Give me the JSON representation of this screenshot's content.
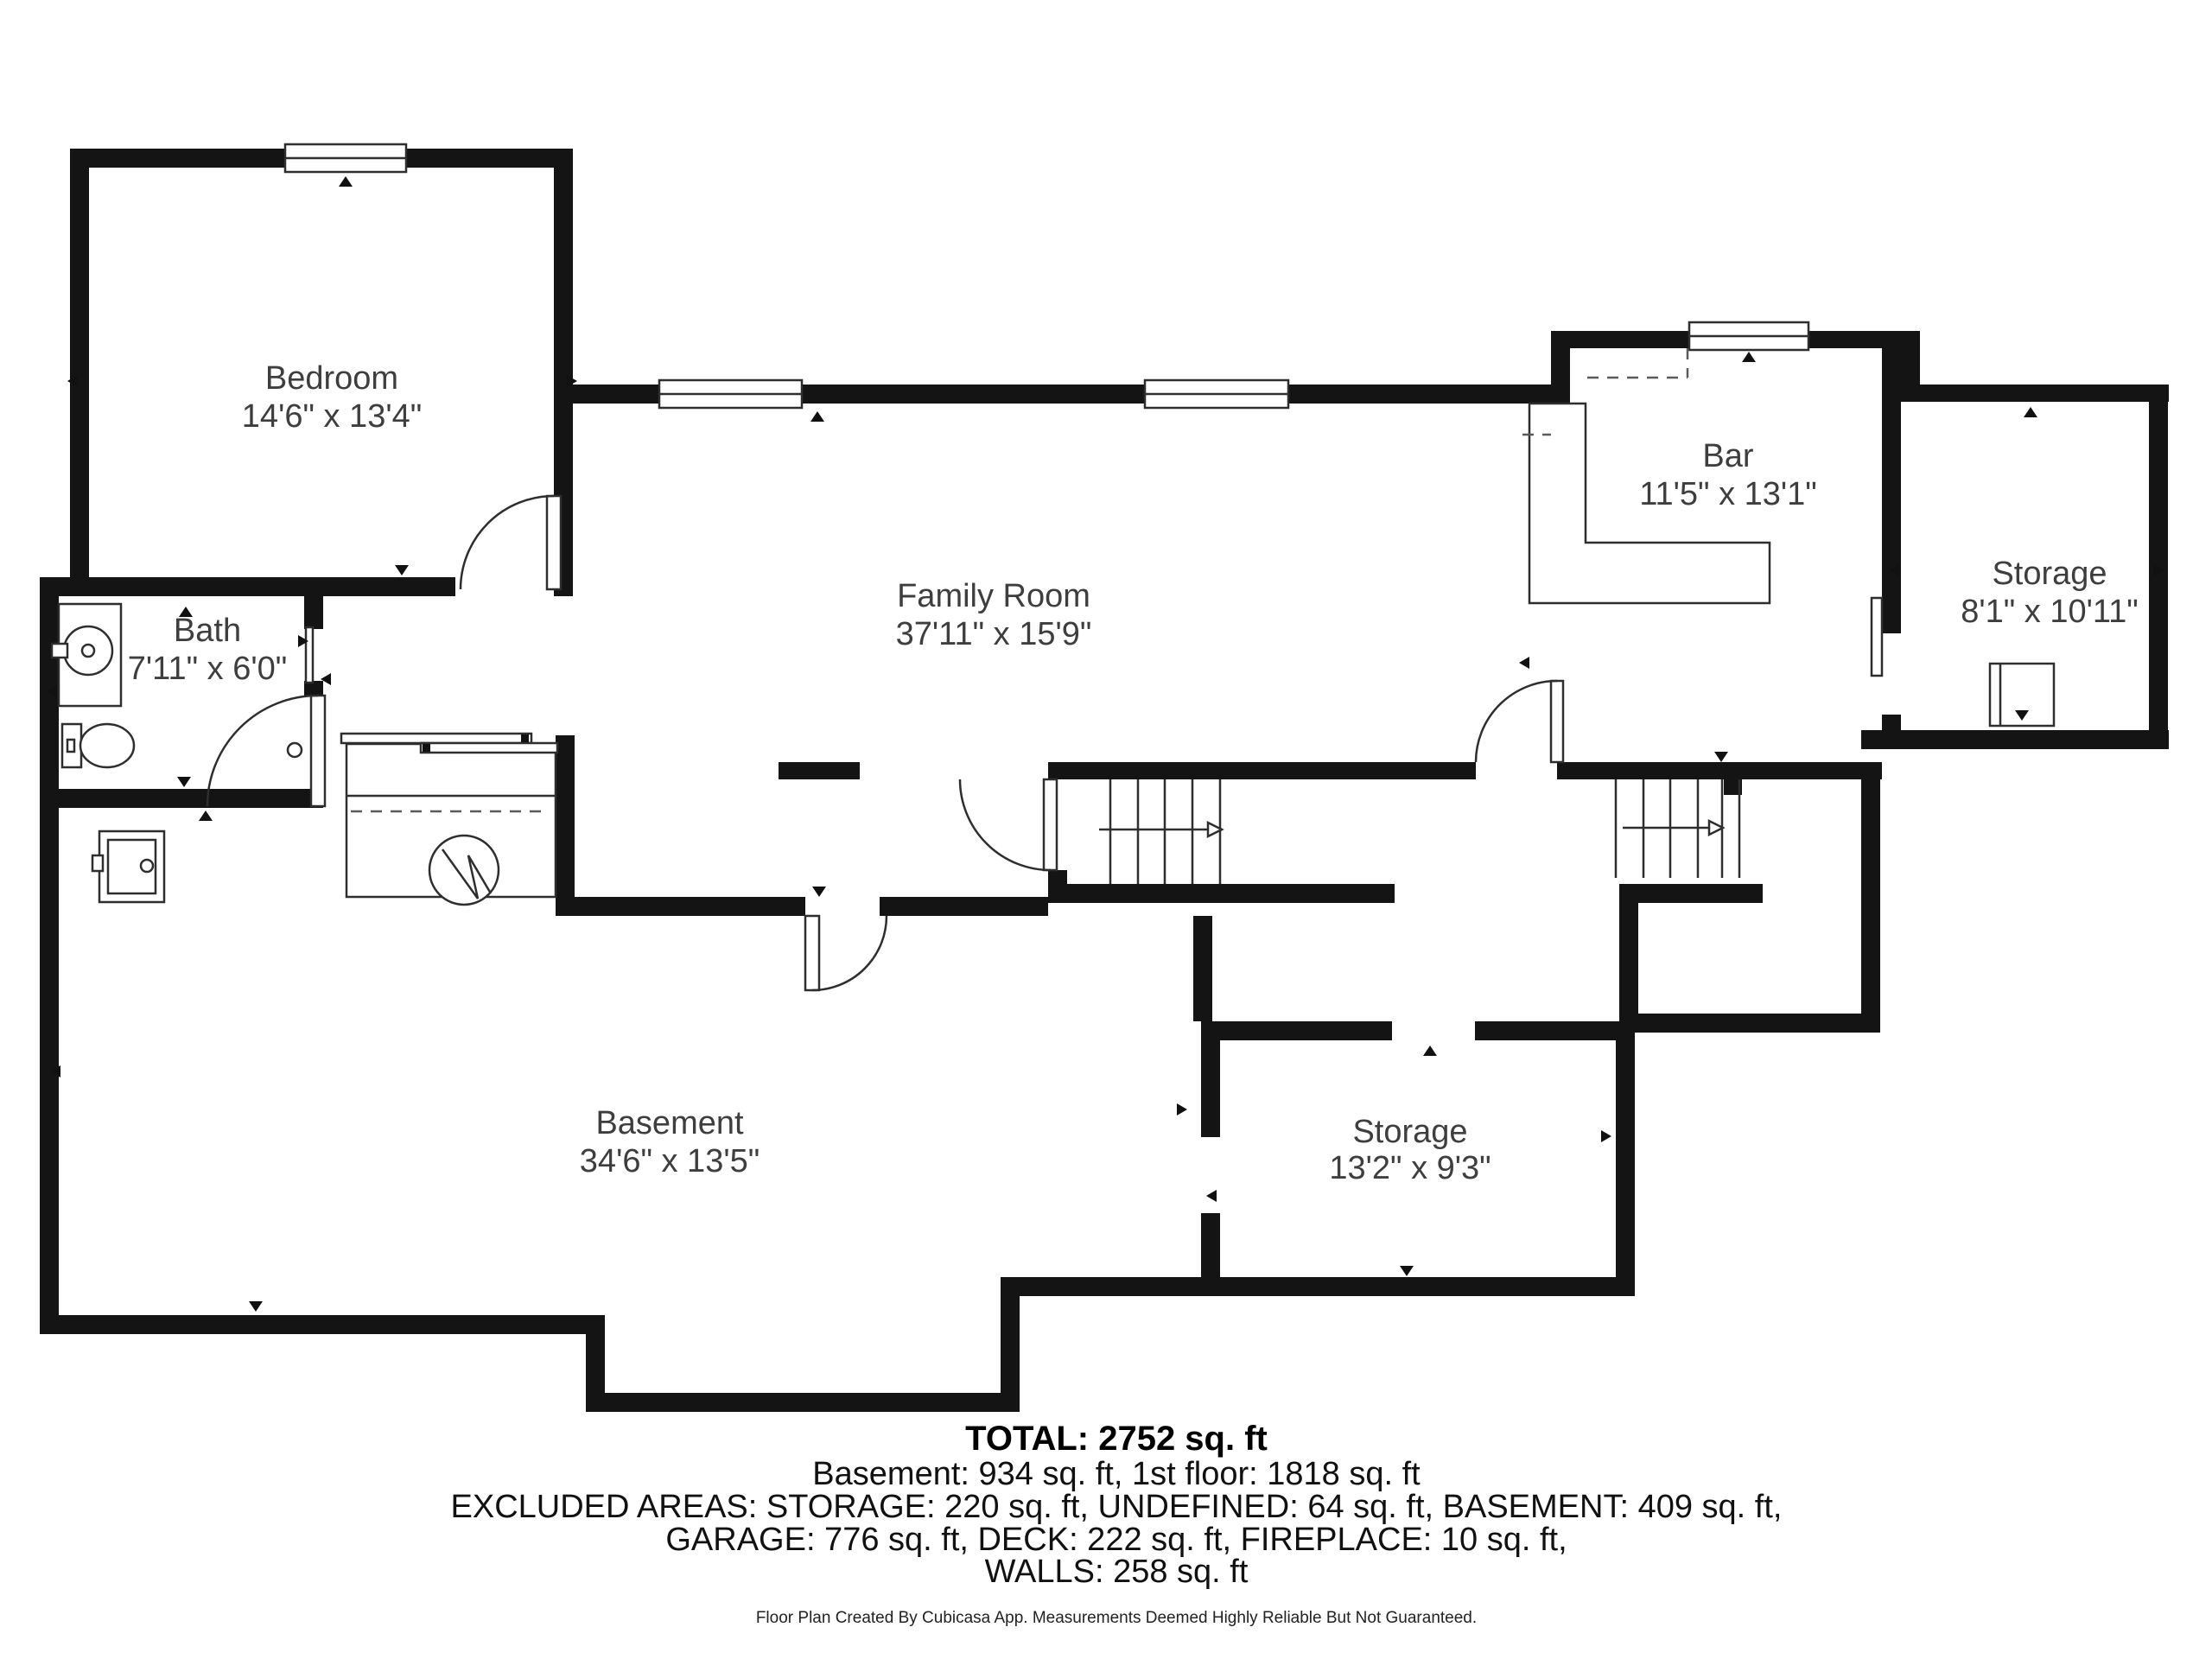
{
  "plan": {
    "type": "basement-floor-plan",
    "rooms": {
      "bedroom": {
        "name": "Bedroom",
        "dimensions": "14'6\" x 13'4\""
      },
      "bath": {
        "name": "Bath",
        "dimensions": "7'11\" x 6'0\""
      },
      "family_room": {
        "name": "Family Room",
        "dimensions": "37'11\" x 15'9\""
      },
      "bar": {
        "name": "Bar",
        "dimensions": "11'5\" x 13'1\""
      },
      "storage_upper": {
        "name": "Storage",
        "dimensions": "8'1\" x 10'11\""
      },
      "basement": {
        "name": "Basement",
        "dimensions": "34'6\" x 13'5\""
      },
      "storage_lower": {
        "name": "Storage",
        "dimensions": "13'2\" x 9'3\""
      }
    },
    "summary": {
      "total": "TOTAL: 2752 sq. ft",
      "floors": "Basement: 934 sq. ft, 1st floor: 1818 sq. ft",
      "excluded1": "EXCLUDED AREAS: STORAGE: 220 sq. ft, UNDEFINED: 64 sq. ft, BASEMENT: 409 sq. ft,",
      "excluded2": "GARAGE: 776 sq. ft, DECK: 222 sq. ft, FIREPLACE: 10 sq. ft,",
      "walls": "WALLS: 258 sq. ft"
    },
    "credit": "Floor Plan Created By Cubicasa App. Measurements Deemed Highly Reliable But Not Guaranteed.",
    "colors": {
      "wall": "#141414",
      "background": "#ffffff",
      "label_text": "#3e3e3e",
      "summary_text": "#111111"
    }
  }
}
